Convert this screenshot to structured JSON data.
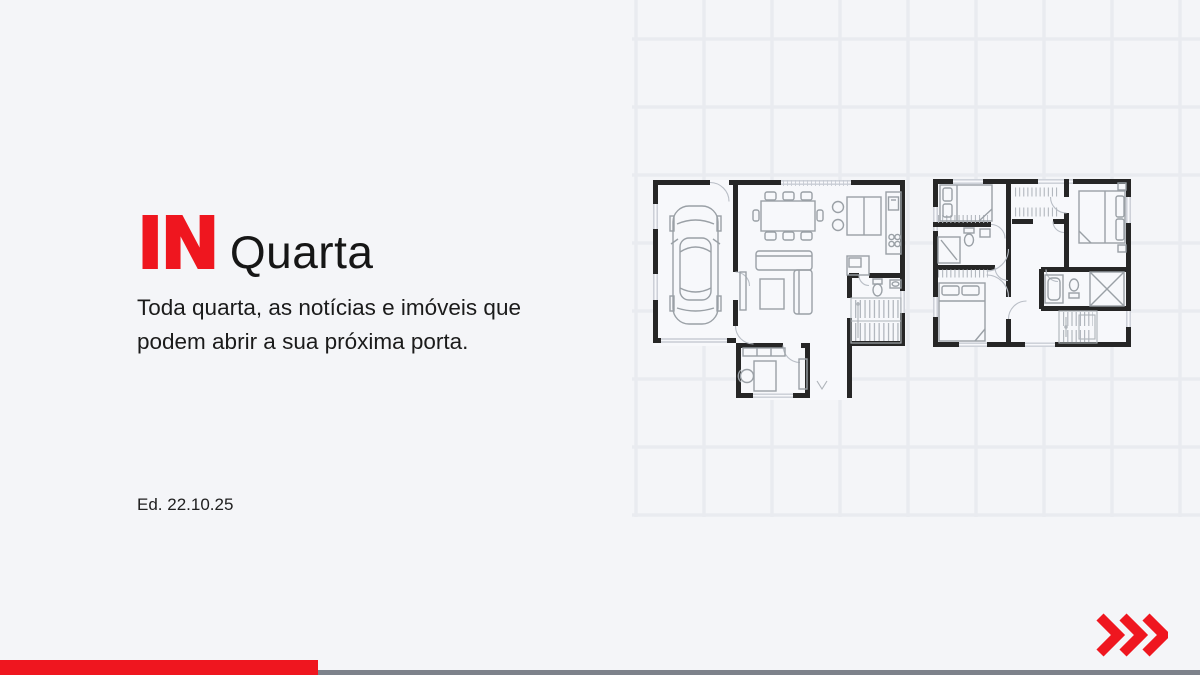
{
  "meta": {
    "background_color": "#f4f5f8",
    "accent_color": "#ef161f",
    "grid_line_color": "#e9ebf0",
    "baseline_bar_color": "#7d828b"
  },
  "header": {
    "logo": {
      "prefix": "IN",
      "suffix": "Quarta"
    },
    "tagline_line1": "Toda quarta, as notícias e imóveis que",
    "tagline_line2": "podem abrir a sua próxima porta.",
    "edition": "Ed. 22.10.25"
  },
  "illustration": {
    "type": "architectural-floor-plans-on-grid",
    "plans": [
      {
        "name": "ground-floor-plan"
      },
      {
        "name": "upper-floor-plan"
      }
    ]
  },
  "footer": {
    "accent_bar": "red-accent-bar",
    "baseline_bar": "gray-baseline-bar",
    "chevrons_icon": "triple-chevron-right"
  }
}
